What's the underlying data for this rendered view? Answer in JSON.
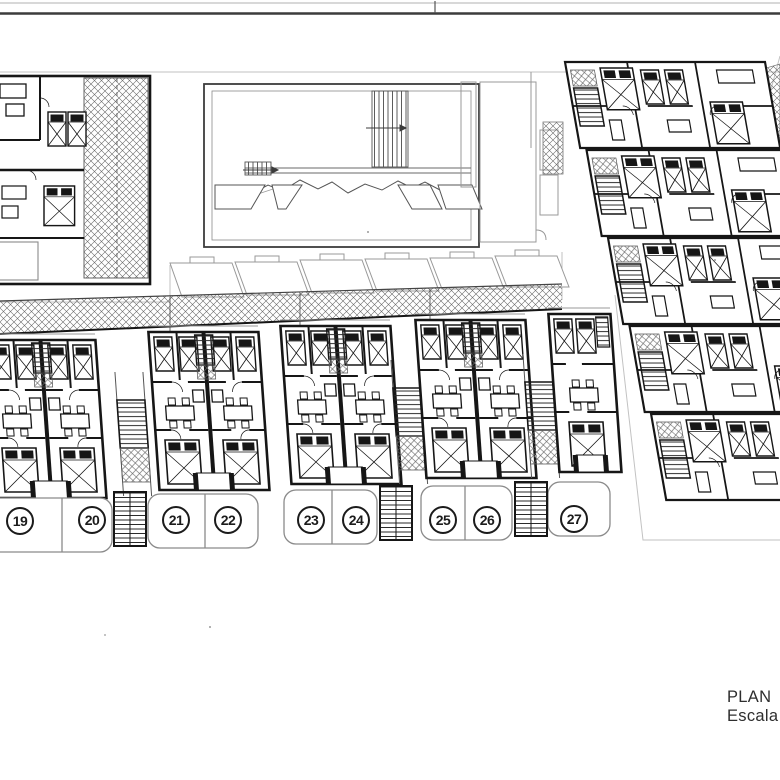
{
  "titleblock": {
    "line1": "PLAN",
    "line2": "Escala"
  },
  "plan": {
    "unit_badges": [
      {
        "number": "19"
      },
      {
        "number": "20"
      },
      {
        "number": "21"
      },
      {
        "number": "22"
      },
      {
        "number": "23"
      },
      {
        "number": "24"
      },
      {
        "number": "25"
      },
      {
        "number": "26"
      },
      {
        "number": "27"
      }
    ]
  },
  "colors": {
    "ink": "#161616",
    "light_line": "#8a8a8a",
    "faint_line": "#c2c2c2",
    "frame_dark": "#3c3c3c"
  }
}
